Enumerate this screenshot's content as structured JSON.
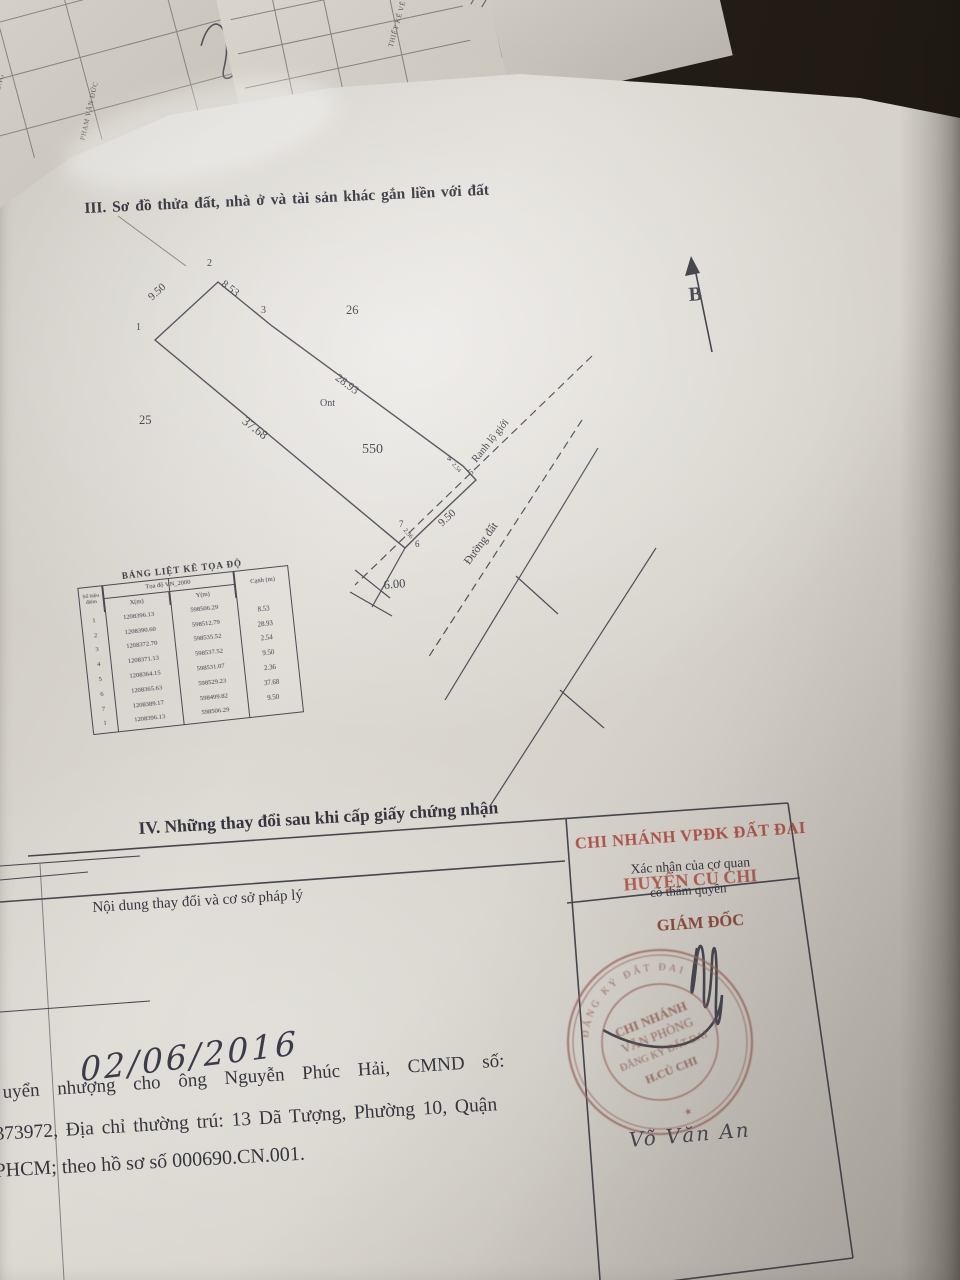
{
  "background_papers": {
    "left_text_1": "PHẠM VĂN ĐỨC",
    "left_text_2": "VĂN ĐỒNG",
    "mid_text_1": "THIẾT KẾ VẼ",
    "mid_text_2": "GHI CHÚ",
    "mid_text_red": "ĐỒNG"
  },
  "section3": {
    "title": "III. Sơ đồ thửa đất, nhà ở và tài sản khác gắn liền với đất"
  },
  "diagram": {
    "north_label": "B",
    "parcel_number": "550",
    "land_type": "Ont",
    "adjacent_parcel_left": "25",
    "adjacent_parcel_top": "26",
    "road_boundary_label": "Ranh lộ giới",
    "road_name": "Đường đất",
    "vertices": {
      "v1": "1",
      "v2": "2",
      "v3": "3",
      "v4": "4",
      "v5": "5",
      "v6": "6",
      "v7": "7"
    },
    "edges": {
      "e_1_2": "9.50",
      "e_2_3": "8.53",
      "e_3_4": "28.93",
      "e_bottom": "37.68",
      "e_front": "9.50",
      "e_jog_top": "2.54",
      "e_jog_bottom": "2.36",
      "road_width": "6.00"
    }
  },
  "coord_table": {
    "title": "BẢNG LIỆT KÊ TỌA ĐỘ",
    "header_point": "Số hiệu điểm",
    "header_coord": "Tọa độ VN_2000",
    "header_x": "X(m)",
    "header_y": "Y(m)",
    "header_edge": "Cạnh (m)",
    "rows": [
      {
        "point": "1",
        "x": "1208396.13",
        "y": "598506.29"
      },
      {
        "point": "2",
        "x": "1208390.60",
        "y": "598512.79"
      },
      {
        "point": "3",
        "x": "1208372.70",
        "y": "598535.52"
      },
      {
        "point": "4",
        "x": "1208371.13",
        "y": "598537.52"
      },
      {
        "point": "5",
        "x": "1208364.15",
        "y": "598531.07"
      },
      {
        "point": "6",
        "x": "1208365.63",
        "y": "598529.23"
      },
      {
        "point": "7",
        "x": "1208389.17",
        "y": "598499.82"
      },
      {
        "point": "1",
        "x": "1208396.13",
        "y": "598506.29"
      }
    ],
    "edge_values": [
      "8.53",
      "28.93",
      "2.54",
      "9.50",
      "2.36",
      "37.68",
      "9.50"
    ]
  },
  "section4": {
    "title": "IV. Những thay đổi sau khi cấp giấy chứng nhận",
    "left_column_header": "Nội dung thay đổi và cơ sở pháp lý",
    "right_column_header_line1": "Xác nhận của cơ quan",
    "right_column_header_line2": "có thẩm quyền",
    "stamp_text_line1": "CHI NHÁNH VPĐK ĐẤT ĐAI",
    "stamp_text_line2": "HUYỆN CỦ CHI",
    "director_title": "GIÁM ĐỐC"
  },
  "round_stamp": {
    "ring_text": "ĐĂNG KÝ ĐẤT ĐAI",
    "ring_mark": "★",
    "center_line1": "CHI NHÁNH",
    "center_line2": "VĂN PHÒNG",
    "center_line3": "ĐĂNG KÝ ĐẤT ĐAI",
    "center_line4": "H.CỦ CHI"
  },
  "handwriting": {
    "date": "02/06/2016",
    "signer_name": "Võ Văn An"
  },
  "entry_text": {
    "line1": "uyển nhượng cho ông Nguyễn Phúc Hải, CMND số:",
    "line2": "373972, Địa chỉ thường trú: 13 Dã Tượng, Phường 10, Quận",
    "line3": "PHCM; theo hồ sơ số 000690.CN.001."
  }
}
